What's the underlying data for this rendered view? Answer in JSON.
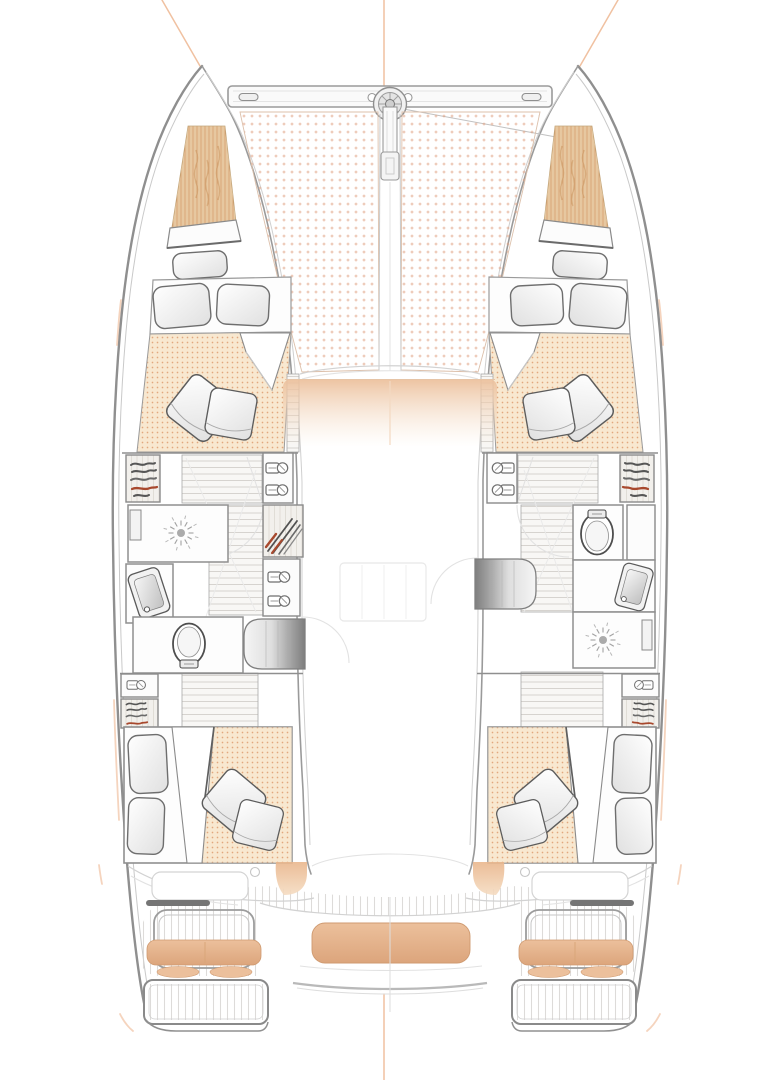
{
  "diagram": {
    "subject": "Top-down interior deck plan of a sailing catamaran, bow up, four double cabins, two bathrooms, trampoline forward, cockpit aft",
    "type": "boat-floorplan",
    "visible_text": []
  },
  "colors": {
    "paper": "#ffffff",
    "hull_line": "#8f8f8f",
    "light_line": "#c9c9c9",
    "inner_line": "#9a9a9a",
    "ghost_line": "#e2e2e2",
    "dark_detail": "#4e4e4e",
    "red_accent": "#a8492e",
    "trampoline_dot": "#dfa183",
    "mattress_bg": "#f8e8d0",
    "mattress_dot": "#e1a87e",
    "stripe_bg": "#f1d7b4",
    "stripe_line": "#cf9764",
    "cushion": "#ecc09c",
    "cushion_edge": "#cf9a70",
    "stairs_dark": "#7e7e7e",
    "wood_floor": "#f8f7f5",
    "plank_line": "#d6d3cf",
    "orange_guide": "#e8a06f"
  },
  "features": {
    "bow": [
      "crossbeam",
      "anchor-windlass",
      "bowsprit",
      "trampoline-port-panel",
      "trampoline-starboard-panel"
    ],
    "port_hull": [
      "forward-double-berth",
      "hanging-wardrobe",
      "shelf-cabinets",
      "shower",
      "washbasin",
      "toilet",
      "companionway-stairs",
      "aft-double-berth"
    ],
    "starboard_hull": [
      "forward-double-berth",
      "shelf-cabinets",
      "toilet",
      "washbasin",
      "shower",
      "companionway-stairs",
      "aft-double-berth"
    ],
    "cockpit": [
      "port-bench-cushion",
      "center-bench-cushion",
      "starboard-bench-cushion",
      "port-transom-platform",
      "starboard-transom-platform",
      "teak-deck"
    ]
  },
  "counts": {
    "berths": 4,
    "scatter_pillows": 8,
    "showers": 2,
    "toilets": 2,
    "washbasins": 2,
    "trampoline_panels": 2,
    "cockpit_cushions": 3,
    "transom_platforms": 2
  }
}
